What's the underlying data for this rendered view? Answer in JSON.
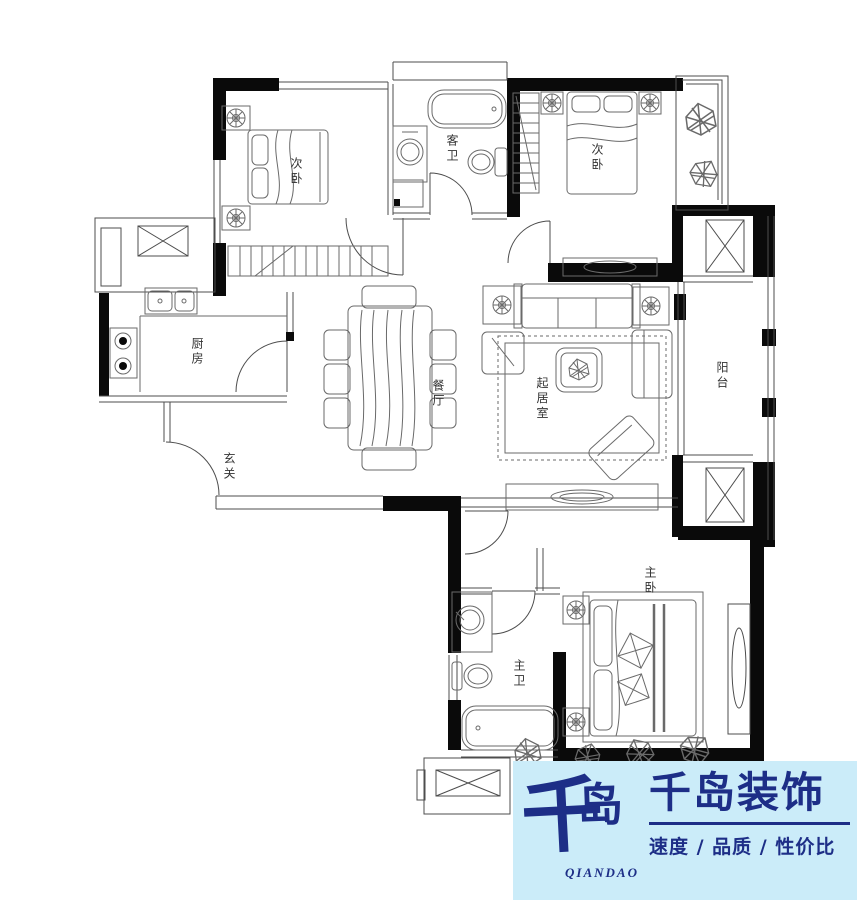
{
  "plan": {
    "colors": {
      "background": "#ffffff",
      "wall": "#0a0a0a",
      "thin_line": "#4d4d4d",
      "furniture_line": "#6a6a6a",
      "label_text": "#333333"
    },
    "rooms": [
      {
        "id": "bedroom-nw",
        "label": "次卧"
      },
      {
        "id": "guest-bath",
        "label": "客卫"
      },
      {
        "id": "bedroom-ne",
        "label": "次卧"
      },
      {
        "id": "kitchen",
        "label": "厨房"
      },
      {
        "id": "entry",
        "label": "玄关"
      },
      {
        "id": "dining",
        "label": "餐厅"
      },
      {
        "id": "living",
        "label": "起居室"
      },
      {
        "id": "balcony",
        "label": "阳台"
      },
      {
        "id": "master-bath",
        "label": "主卫"
      },
      {
        "id": "master-bedroom",
        "label": "主卧"
      }
    ]
  },
  "brand": {
    "colors": {
      "background": "#cbecf9",
      "ink": "#1d2e87"
    },
    "logo_mark_char1": "千",
    "logo_mark_char2": "岛",
    "logo_caption": "QIANDAO",
    "company_name": "千岛装饰",
    "slogan": "速度 / 品质 / 性价比"
  }
}
